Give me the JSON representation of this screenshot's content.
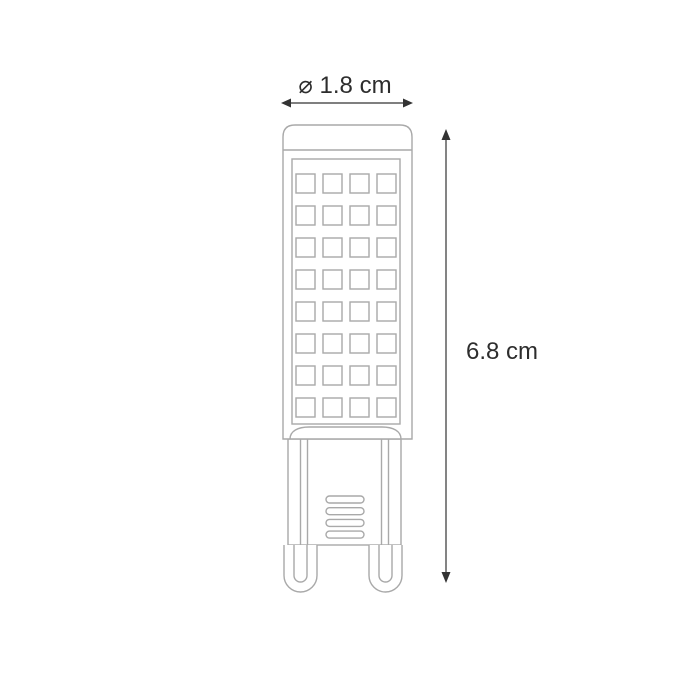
{
  "figure": {
    "subject": "G9 LED bulb technical line drawing",
    "dimensions": {
      "diameter_label": "⌀ 1.8 cm",
      "height_label": "6.8 cm"
    },
    "led_grid": {
      "rows": 8,
      "columns": 4
    },
    "vent_slots": {
      "count": 4
    },
    "pins": {
      "count": 2
    },
    "colors": {
      "background": "#ffffff",
      "drawing_stroke": "#a9a9a9",
      "dimension_stroke": "#333333",
      "text": "#2d2d2d"
    }
  }
}
